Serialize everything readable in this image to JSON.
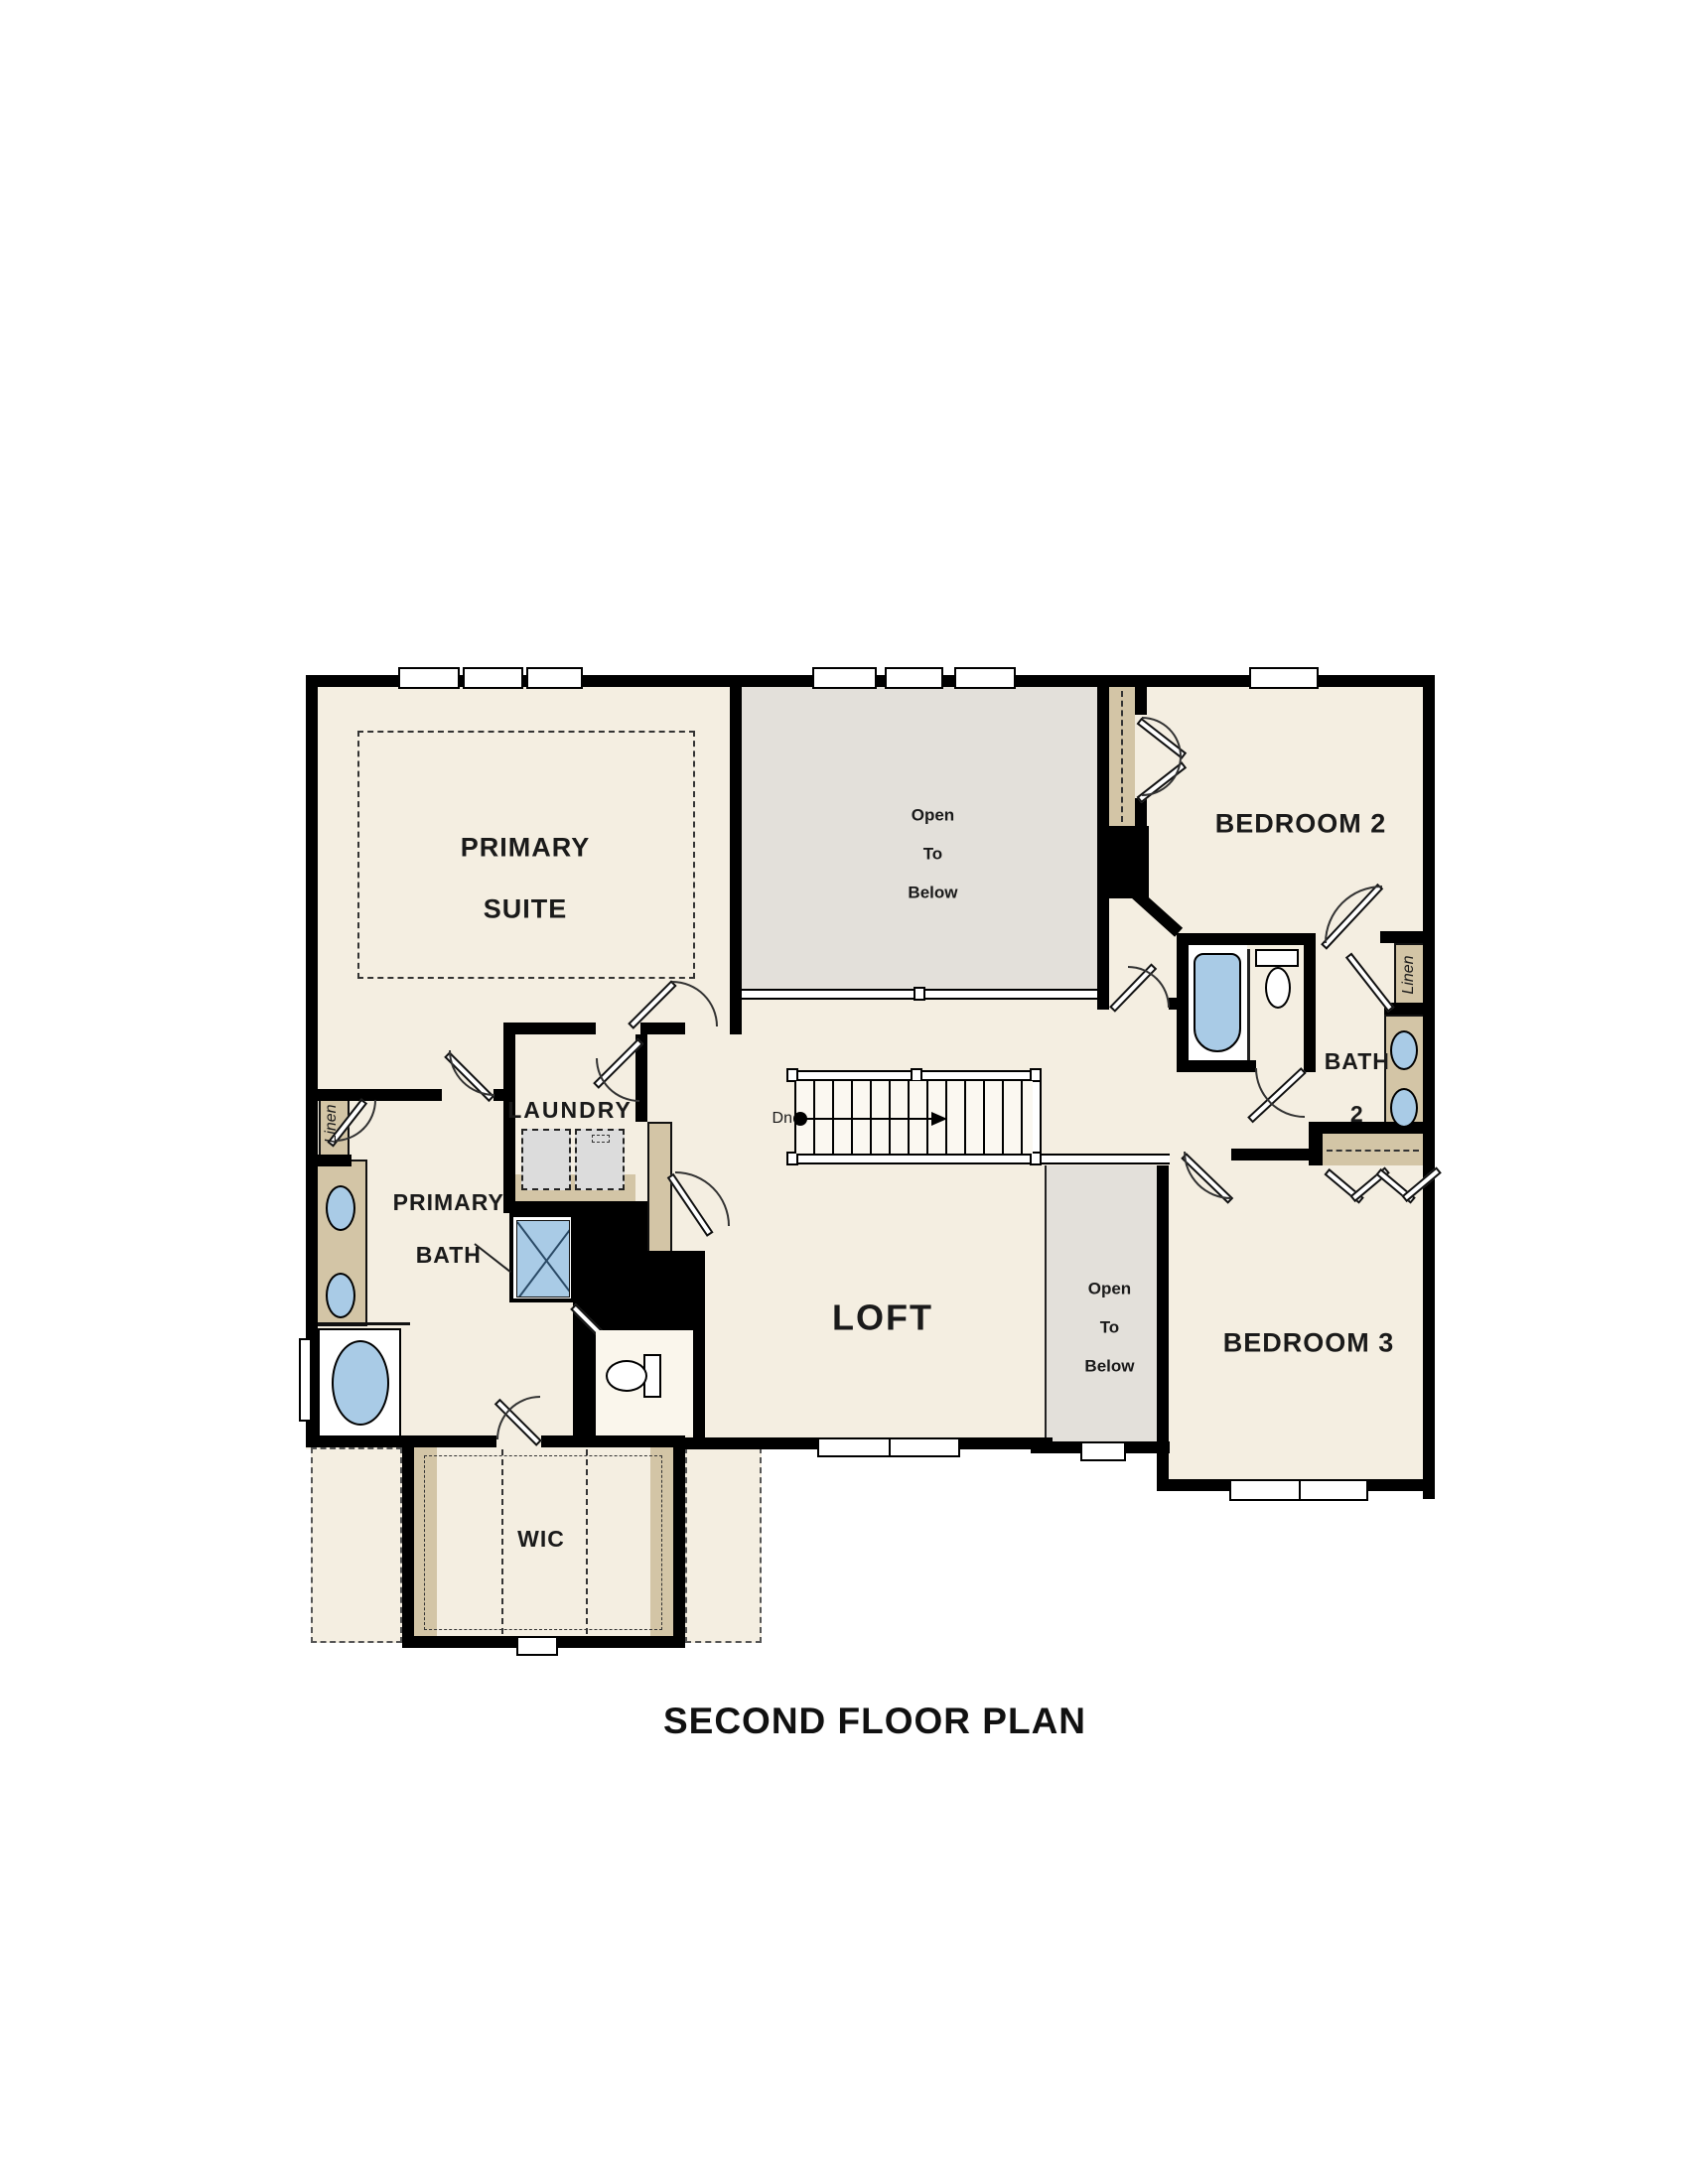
{
  "title": "SECOND FLOOR PLAN",
  "labels": {
    "primary_suite_l1": "PRIMARY",
    "primary_suite_l2": "SUITE",
    "open_below_l1": "Open",
    "open_below_l2": "To",
    "open_below_l3": "Below",
    "bedroom2": "BEDROOM 2",
    "bedroom3": "BEDROOM 3",
    "bath2_l1": "BATH",
    "bath2_l2": "2",
    "linen": "Linen",
    "loft": "LOFT",
    "laundry": "LAUNDRY",
    "primary_bath_l1": "PRIMARY",
    "primary_bath_l2": "BATH",
    "wic": "WIC",
    "dn": "Dn"
  },
  "colors": {
    "floor": "#f4eee1",
    "open_to_below": "#e3e0da",
    "wall": "#000000",
    "cabinet_tan": "#d3c5a6",
    "fixture_blue": "#a9cbe6",
    "appliance_gray": "#dcdcdc",
    "label_text": "#1a1a1a"
  }
}
